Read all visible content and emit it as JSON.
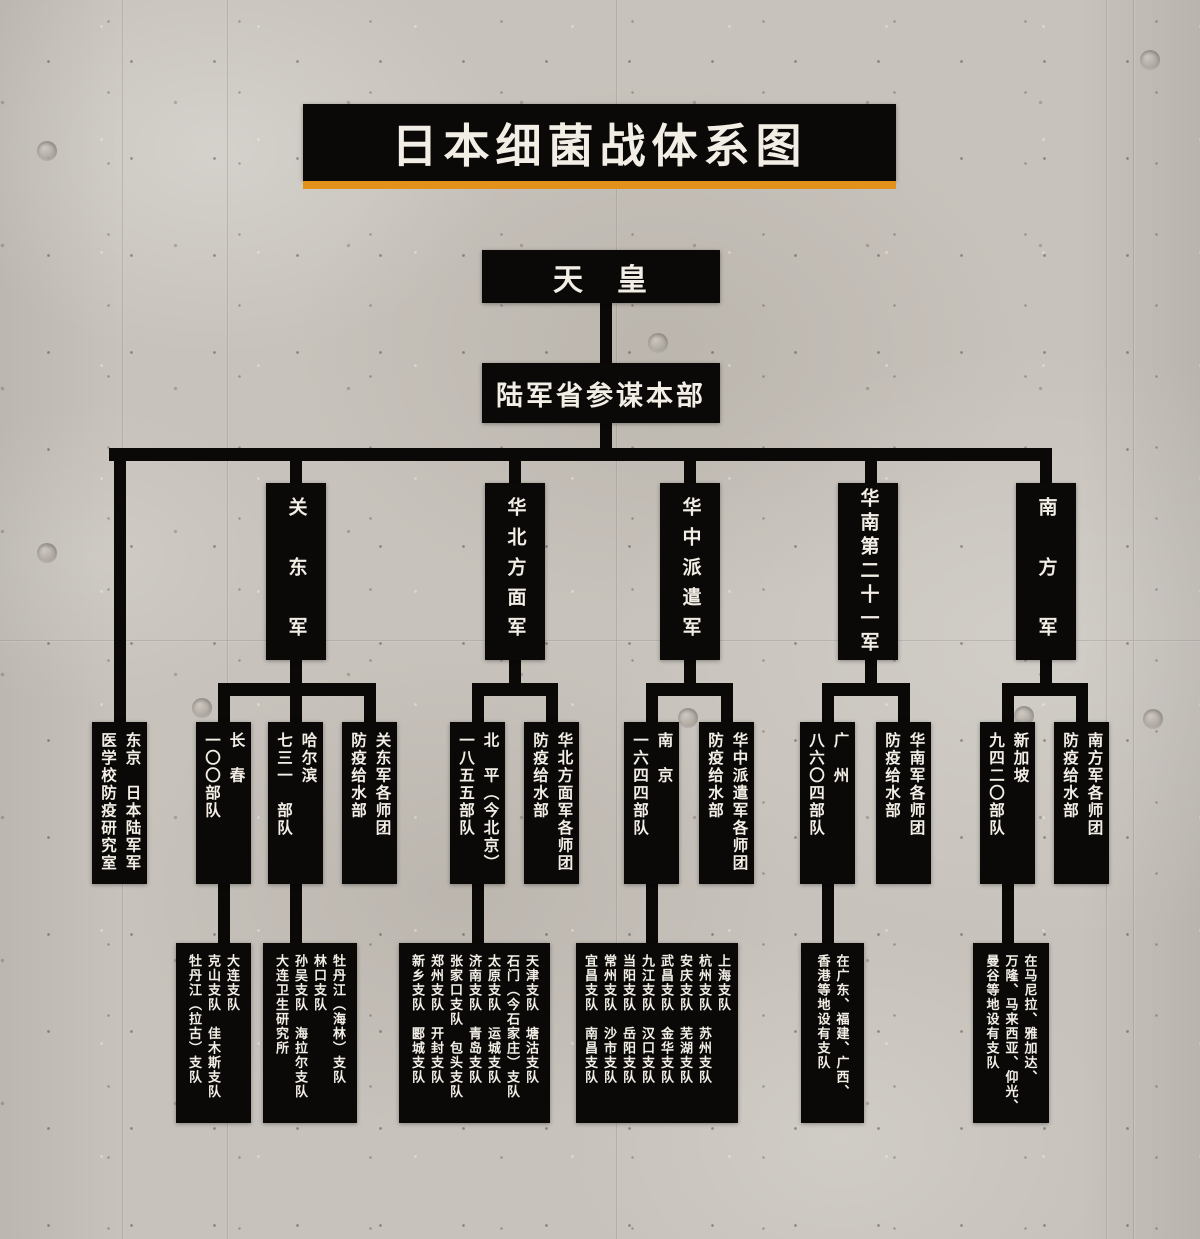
{
  "poster": {
    "title": "日本细菌战体系图",
    "colors": {
      "panel_black": "#0b0908",
      "text_light": "#f2eee6",
      "accent_orange": "#e2921b",
      "concrete_gray": "#c7c2bb"
    }
  },
  "tree": {
    "emperor": "天　皇",
    "staff_hq": "陆军省参谋本部",
    "armies": {
      "kwantung": "关　东　军",
      "north_china": "华北方面军",
      "central_china": "华中派遣军",
      "south_china": "华南第二十一军",
      "southern": "南　方　军"
    },
    "level2": {
      "tokyo": [
        "东京　日本陆军军",
        "医学校防疫研究室"
      ],
      "changchun": [
        "长　春",
        "一〇〇部队"
      ],
      "harbin": [
        "哈尔滨",
        "七三一　部队"
      ],
      "kwantung_div": [
        "关东军各师团",
        "防疫给水部"
      ],
      "beiping": [
        "北　平（今北京）",
        "一八五五部队"
      ],
      "north_china_div": [
        "华北方面军各师团",
        "防疫给水部"
      ],
      "nanjing": [
        "南　京",
        "一六四四部队"
      ],
      "central_china_div": [
        "华中派遣军各师团",
        "防疫给水部"
      ],
      "guangzhou": [
        "广　州",
        "八六〇四部队"
      ],
      "south_china_div": [
        "华南军各师团",
        "防疫给水部"
      ],
      "singapore": [
        "新加坡",
        "九四二〇部队"
      ],
      "southern_div": [
        "南方军各师团",
        "防疫给水部"
      ]
    },
    "level3": {
      "unit100_branches": [
        "大连支队",
        "克山支队　佳木斯支队",
        "牡丹江（拉古）支队"
      ],
      "unit731_branches": [
        "牡丹江（海林）支队",
        "林口支队",
        "孙吴支队　海拉尔支队",
        "大连卫生研究所"
      ],
      "unit1855_branches": [
        "天津支队　塘沽支队",
        "石门（今石家庄）支队",
        "太原支队　运城支队",
        "济南支队　青岛支队",
        "张家口支队　包头支队",
        "郑州支队　开封支队",
        "新乡支队　郾城支队"
      ],
      "unit1644_branches": [
        "上海支队",
        "杭州支队　苏州支队",
        "安庆支队　芜湖支队",
        "武昌支队　金华支队",
        "九江支队　汉口支队",
        "当阳支队　岳阳支队",
        "常州支队　沙市支队",
        "宜昌支队　南昌支队"
      ],
      "unit8604_branches": [
        "在广东、福建、广西、",
        "香港等地设有支队"
      ],
      "unit9420_branches": [
        "在马尼拉、雅加达、",
        "万隆、马来西亚、仰光、",
        "曼谷等地设有支队"
      ]
    }
  }
}
